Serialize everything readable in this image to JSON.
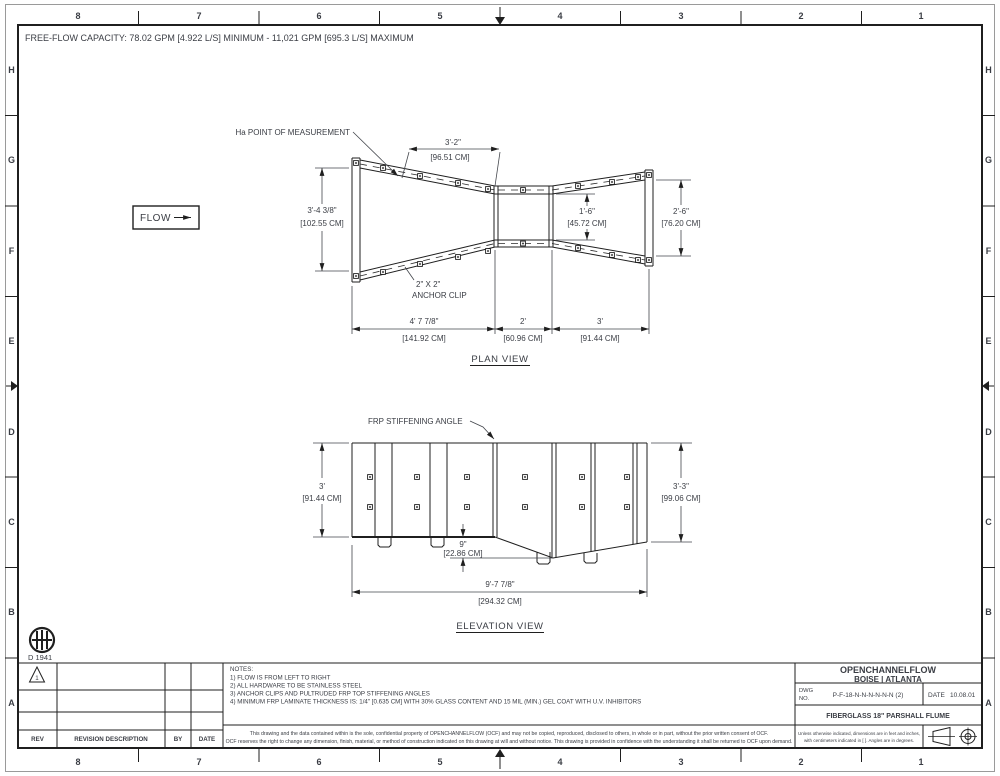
{
  "colors": {
    "line": "#1f1f1f",
    "text": "#3a3d44",
    "paper": "#ffffff"
  },
  "header": {
    "capacity_note": "FREE-FLOW CAPACITY:  78.02 GPM [4.922 L/S] MINIMUM - 11,021 GPM [695.3 L/S] MAXIMUM"
  },
  "grid": {
    "columns": [
      "8",
      "7",
      "6",
      "5",
      "4",
      "3",
      "2",
      "1"
    ],
    "rows": [
      "H",
      "G",
      "F",
      "E",
      "D",
      "C",
      "B",
      "A"
    ]
  },
  "plan_view": {
    "title": "PLAN VIEW",
    "flow_label": "FLOW",
    "ha_label": "Ha POINT OF MEASUREMENT",
    "clip_size_label": "2\" X 2\"",
    "clip_name_label": "ANCHOR CLIP",
    "dims": {
      "ha_distance": [
        "3'-2\"",
        "[96.51 CM]"
      ],
      "entrance_width": [
        "3'-4 3/8\"",
        "[102.55 CM]"
      ],
      "throat_width": [
        "1'-6\"",
        "[45.72 CM]"
      ],
      "exit_width": [
        "2'-6\"",
        "[76.20 CM]"
      ],
      "converging_length": [
        "4' 7 7/8\"",
        "[141.92 CM]"
      ],
      "throat_length": [
        "2'",
        "[60.96 CM]"
      ],
      "diverging_length": [
        "3'",
        "[91.44 CM]"
      ]
    }
  },
  "elevation_view": {
    "title": "ELEVATION VIEW",
    "stiffener_label": "FRP STIFFENING ANGLE",
    "dims": {
      "left_height": [
        "3'",
        "[91.44 CM]"
      ],
      "right_height": [
        "3'-3\"",
        "[99.06 CM]"
      ],
      "floor_drop": [
        "9\"",
        "[22.86 CM]"
      ],
      "overall_length": [
        "9'-7 7/8\"",
        "[294.32 CM]"
      ]
    }
  },
  "revision_table": {
    "headers": [
      "REV",
      "REVISION DESCRIPTION",
      "BY",
      "DATE"
    ],
    "revision_marker": "1"
  },
  "standard_ref": "D 1941",
  "notes": {
    "title": "NOTES:",
    "items": [
      "1)  FLOW IS FROM LEFT TO RIGHT",
      "2)  ALL HARDWARE TO BE STAINLESS STEEL",
      "3)  ANCHOR CLIPS AND PULTRUDED FRP TOP STIFFENING ANGLES",
      "4)  MINIMUM FRP LAMINATE THICKNESS IS:  1/4\" [0.635 CM]  WITH 30% GLASS CONTENT AND 15 MIL (MIN.) GEL COAT WITH U.V. INHIBITORS"
    ]
  },
  "disclaimer": {
    "line1": "This drawing and the data contained within is the sole, confidential property of OPENCHANNELFLOW (OCF) and may not be copied, reproduced, disclosed to others, in whole or in part, without the prior written consent of OCF.",
    "line2": "OCF reserves the right to change any dimension, finish, material, or method of construction indicated on this drawing at will and without notice.  This drawing is provided in confidence with the understanding it shall be returned to OCF upon demand."
  },
  "title_block": {
    "company": "OPENCHANNELFLOW",
    "locations": "BOISE | ATLANTA",
    "dwg_label_1": "DWG",
    "dwg_label_2": "NO.",
    "dwg_no": "P-F-18-N-N-N-N-N-N (2)",
    "date_label": "DATE",
    "date_value": "10.08.01",
    "drawing_title": "FIBERGLASS 18\" PARSHALL FLUME",
    "units_note_1": "Unless otherwise indicated, dimensions are in feet and inches,",
    "units_note_2": "with centimeters indicated in [ ].  Angles are in degrees."
  }
}
